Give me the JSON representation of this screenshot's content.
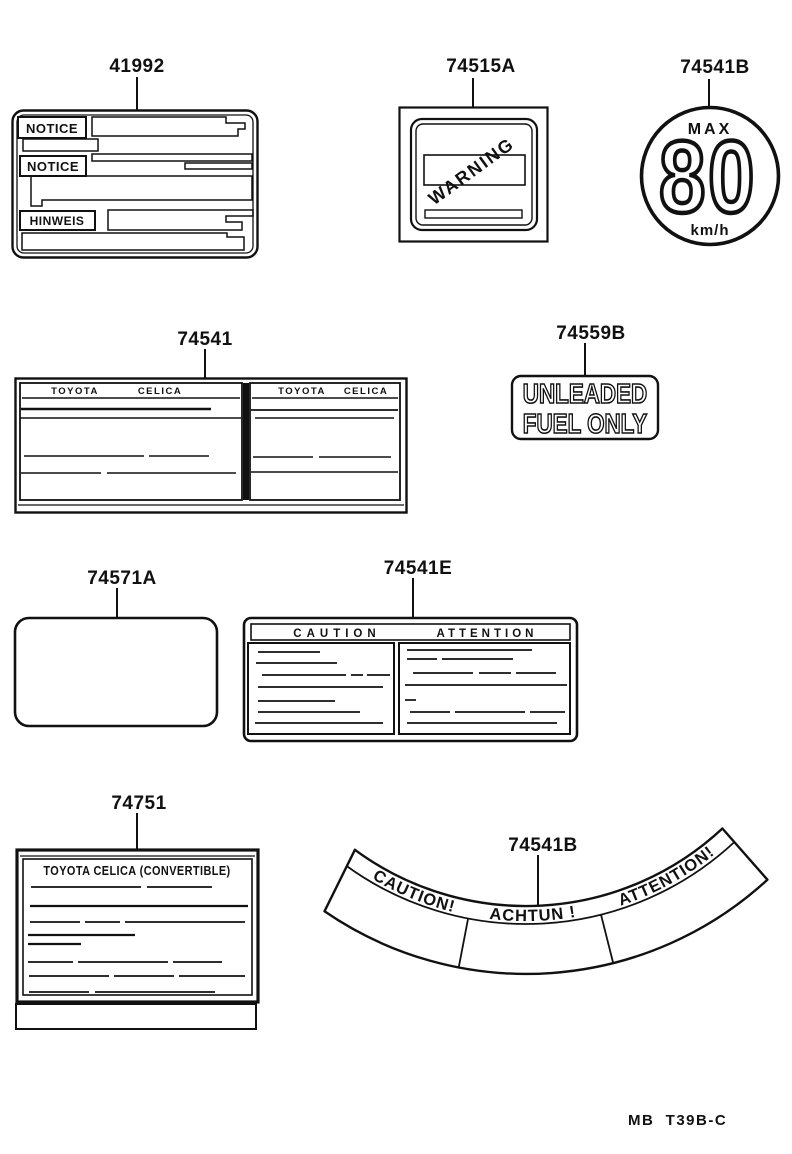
{
  "page": {
    "footer_code": "MB  T39B-C"
  },
  "labels": {
    "notice_label": {
      "part_number": "41992",
      "notice_en_1": "NOTICE",
      "notice_en_2": "NOTICE",
      "notice_de": "HINWEIS"
    },
    "warning_label": {
      "part_number": "74515A",
      "warning": "WARNING"
    },
    "speed_limit_label": {
      "part_number": "74541B",
      "max": "MAX",
      "speed": "80",
      "unit": "km/h"
    },
    "info_table_label": {
      "part_number": "74541",
      "left_header_brand": "TOYOTA",
      "left_header_model": "CELICA",
      "right_header_brand": "TOYOTA",
      "right_header_model": "CELICA"
    },
    "fuel_label": {
      "part_number": "74559B",
      "line1": "UNLEADED",
      "line2": "FUEL ONLY"
    },
    "blank_label": {
      "part_number": "74571A"
    },
    "caution_label": {
      "part_number": "74541E",
      "caution": "CAUTION",
      "attention": "ATTENTION"
    },
    "convertible_label": {
      "part_number": "74751",
      "title": "TOYOTA CELICA (CONVERTIBLE)"
    },
    "caution_band_label": {
      "part_number": "74541B",
      "caution": "CAUTION!",
      "achtung": "ACHTUN !",
      "attention": "ATTENTION!"
    }
  }
}
